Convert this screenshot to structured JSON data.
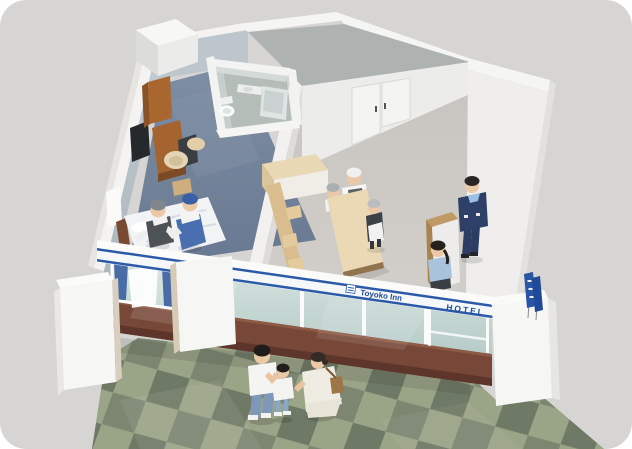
{
  "scene": {
    "description": "Isometric cutaway illustration of a Toyoko Inn hotel: guest room with two housekeepers making a bed, unit bathroom, lobby with front-desk staff and receptionist, street-front signage band and green checkered sidewalk with a passing family",
    "signage": {
      "brand": "Toyoko Inn",
      "hotel": "HOTEL"
    },
    "areas": [
      "guest-room",
      "unit-bathroom",
      "lobby",
      "front-desk",
      "entrance",
      "sidewalk"
    ],
    "figures": [
      "housekeeper-gray-cap",
      "housekeeper-blue-cap",
      "desk-staff-1",
      "desk-staff-2",
      "desk-staff-3",
      "receptionist",
      "girl-guest",
      "father",
      "boy",
      "mother"
    ],
    "colors": {
      "background": "#d6d5d3",
      "wall_white": "#f4f3f1",
      "room_wall_blue": "#b5bfc6",
      "carpet_blue": "#75859b",
      "lobby_floor": "#ccc9c4",
      "wood_dark": "#a9672f",
      "wood_light": "#ead9b4",
      "spandrel_brown": "#774838",
      "glass_green": "#c7d8d4",
      "sign_blue": "#2a5aa8",
      "uniform_navy": "#2e4068",
      "pavement_light": "#9aa487",
      "pavement_mid": "#7c8671",
      "pavement_dark": "#6f7a66"
    }
  }
}
